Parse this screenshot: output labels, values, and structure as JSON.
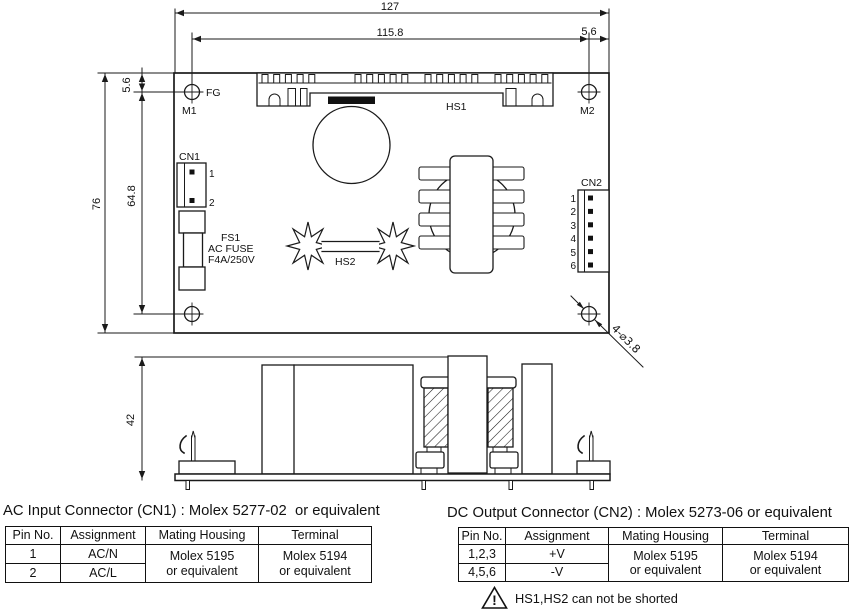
{
  "drawing": {
    "dims": {
      "overall_width": "127",
      "inner_width": "115.8",
      "right_offset": "5.6",
      "top_offset": "5.6",
      "overall_height": "76",
      "inner_height": "64.8",
      "side_height": "42",
      "mounting_holes": "4-⌀3.8"
    },
    "labels": {
      "fg": "FG",
      "m1": "M1",
      "m2": "M2",
      "cn1": "CN1",
      "cn2": "CN2",
      "hs1": "HS1",
      "hs2": "HS2",
      "fs1": "FS1",
      "fuse_type": "AC FUSE",
      "fuse_rating": "F4A/250V"
    },
    "cn1_pins": [
      "1",
      "2"
    ],
    "cn2_pins": [
      "1",
      "2",
      "3",
      "4",
      "5",
      "6"
    ]
  },
  "tables": [
    {
      "title": "AC Input Connector (CN1) : Molex 5277-02  or equivalent",
      "headers": [
        "Pin No.",
        "Assignment",
        "Mating Housing",
        "Terminal"
      ],
      "rows": [
        {
          "pin": "1",
          "assignment": "AC/N"
        },
        {
          "pin": "2",
          "assignment": "AC/L"
        }
      ],
      "mating_housing": [
        "Molex 5195",
        "or equivalent"
      ],
      "terminal": [
        "Molex 5194",
        "or equivalent"
      ]
    },
    {
      "title": "DC Output Connector (CN2) : Molex 5273-06 or equivalent",
      "headers": [
        "Pin No.",
        "Assignment",
        "Mating Housing",
        "Terminal"
      ],
      "rows": [
        {
          "pin": "1,2,3",
          "assignment": "+V"
        },
        {
          "pin": "4,5,6",
          "assignment": "-V"
        }
      ],
      "mating_housing": [
        "Molex 5195",
        "or equivalent"
      ],
      "terminal": [
        "Molex 5194",
        "or equivalent"
      ]
    }
  ],
  "warning": {
    "icon": "!",
    "text": "HS1,HS2 can not be shorted"
  },
  "colors": {
    "line": "#1a1a1a",
    "background": "#ffffff"
  }
}
